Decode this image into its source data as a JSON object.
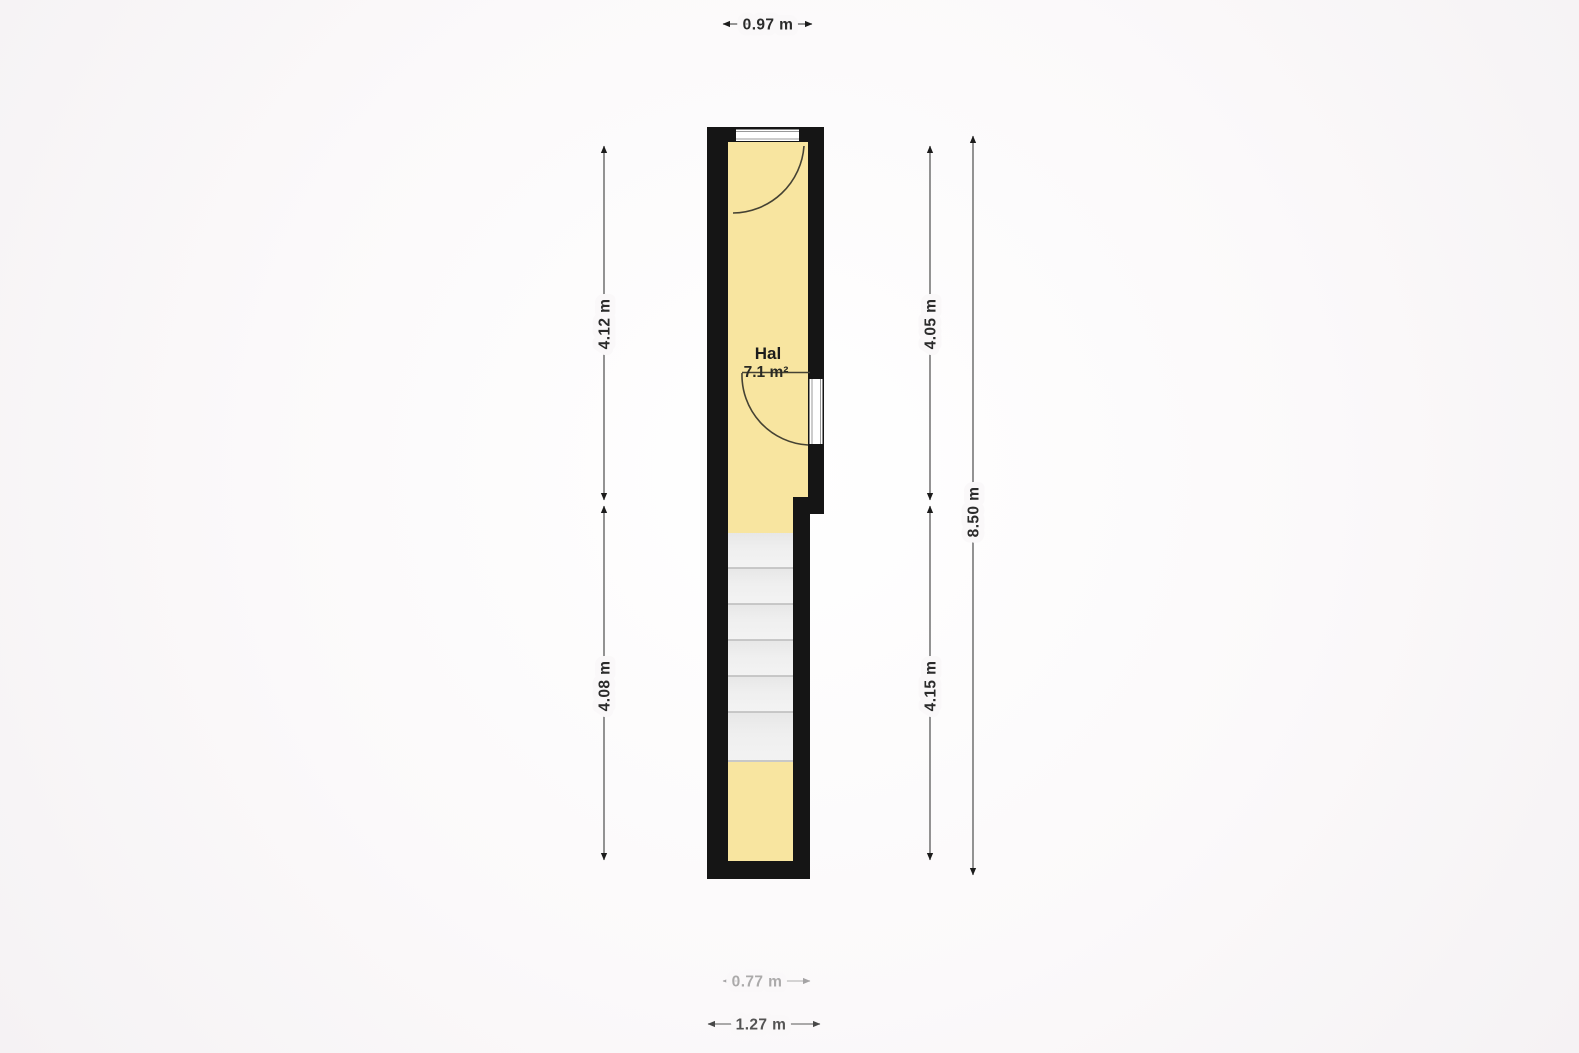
{
  "floorplan": {
    "room": {
      "name": "Hal",
      "area": "7.1 m²"
    },
    "dimensions": {
      "top_width": "0.97 m",
      "left_upper": "4.12 m",
      "left_lower": "4.08 m",
      "right_upper": "4.05 m",
      "right_lower": "4.15 m",
      "right_total": "8.50 m",
      "bottom_inner": "0.77 m",
      "bottom_outer": "1.27 m"
    },
    "colors": {
      "wall": "#151515",
      "floor": "#f8e5a0",
      "door_frame": "#ffffff",
      "stair_top": "#e7e7e7",
      "stair_bottom": "#f3f3f3",
      "dim_line": "#5a5a5a",
      "dim_text": "#2b2b2b"
    }
  }
}
